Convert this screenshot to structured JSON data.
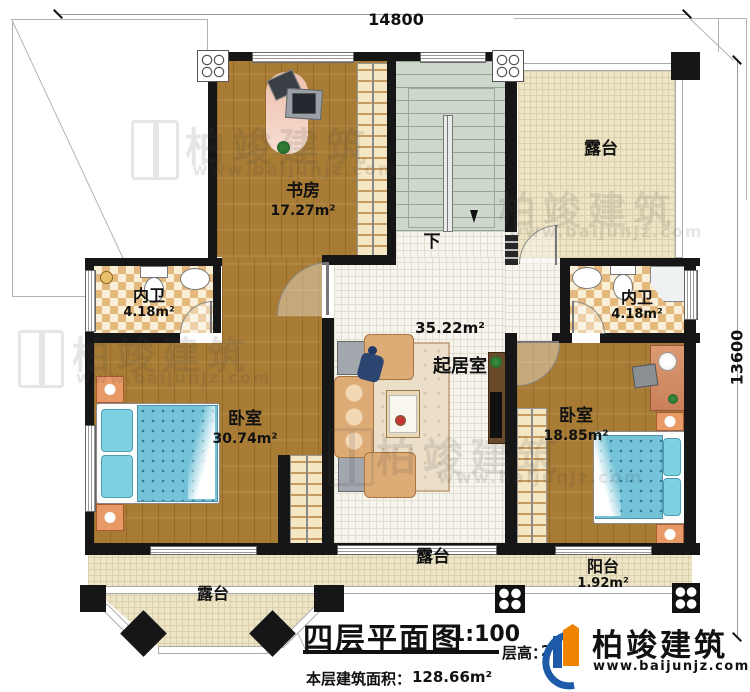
{
  "dimensions": {
    "top": "14800",
    "right": "13600"
  },
  "rooms": {
    "study": {
      "name": "书房",
      "area": "17.27m²"
    },
    "terrace_top": {
      "name": "露台"
    },
    "bath_left": {
      "name": "内卫",
      "area": "4.18m²"
    },
    "bath_right": {
      "name": "内卫",
      "area": "4.18m²"
    },
    "living": {
      "name": "起居室",
      "area": "35.22m²"
    },
    "bedroom_left": {
      "name": "卧室",
      "area": "30.74m²"
    },
    "bedroom_right": {
      "name": "卧室",
      "area": "18.85m²"
    },
    "terrace_bottom_center": {
      "name": "露台"
    },
    "terrace_bottom_left": {
      "name": "露台"
    },
    "balcony": {
      "name": "阳台",
      "area": "1.92m²"
    },
    "stairs": {
      "down_label": "下"
    }
  },
  "titleblock": {
    "title": "四层平面图",
    "scale": "1:100",
    "floor_height_label": "层高：",
    "floor_height_value": "2",
    "building_area_label": "本层建筑面积：",
    "building_area_value": "128.66m²"
  },
  "logo": {
    "name": "柏竣建筑",
    "url": "www.baijunjz.com",
    "blue": "#1d5aa8",
    "orange": "#f08300"
  },
  "watermark": {
    "name": "柏竣建筑",
    "url": "www.baijunjz.com"
  }
}
